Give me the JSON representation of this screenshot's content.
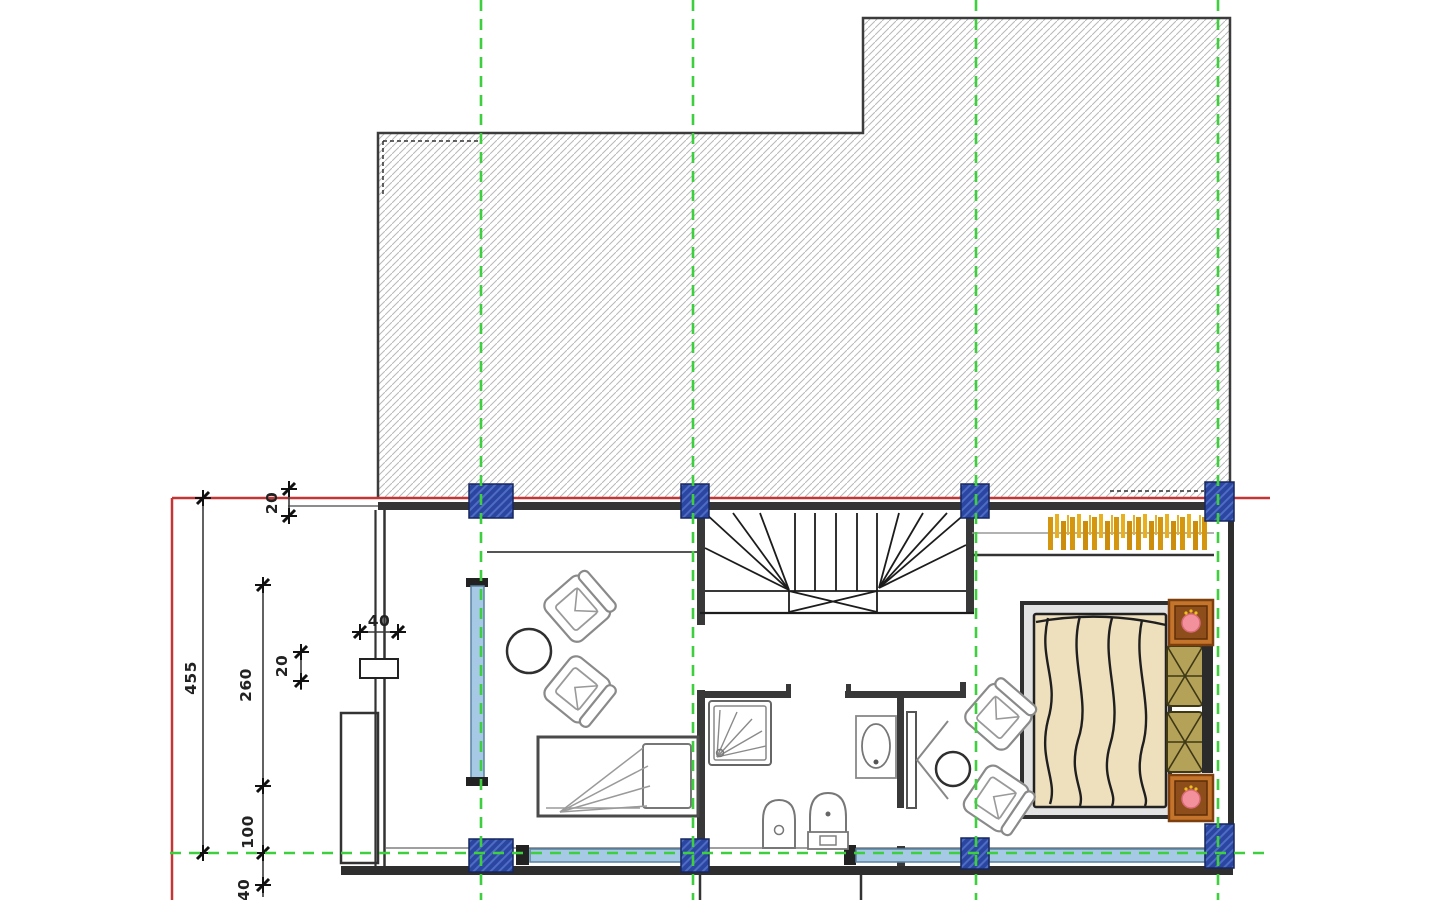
{
  "dimensions": {
    "vertical_total": "455",
    "vertical_window": "260",
    "vertical_pier": "100",
    "vertical_sill": "40",
    "offset_top": "20",
    "offset_mid": "20",
    "pier_width": "40"
  },
  "colors": {
    "grid_green": "#3ecf3e",
    "boundary_red": "#c43535",
    "column_blue": "#2b46a0",
    "column_stripe": "#4e6cc4",
    "window_blue": "#a6c9e6",
    "wall_dark": "#303030",
    "hatch_gray": "#b8b8b8",
    "wardrobe_gold": "#dd9f18",
    "bed_blanket": "#eedfbd",
    "pillow_khaki": "#b3a258",
    "nightstand_orange": "#c4752b",
    "lamp_pink": "#f2909c"
  }
}
